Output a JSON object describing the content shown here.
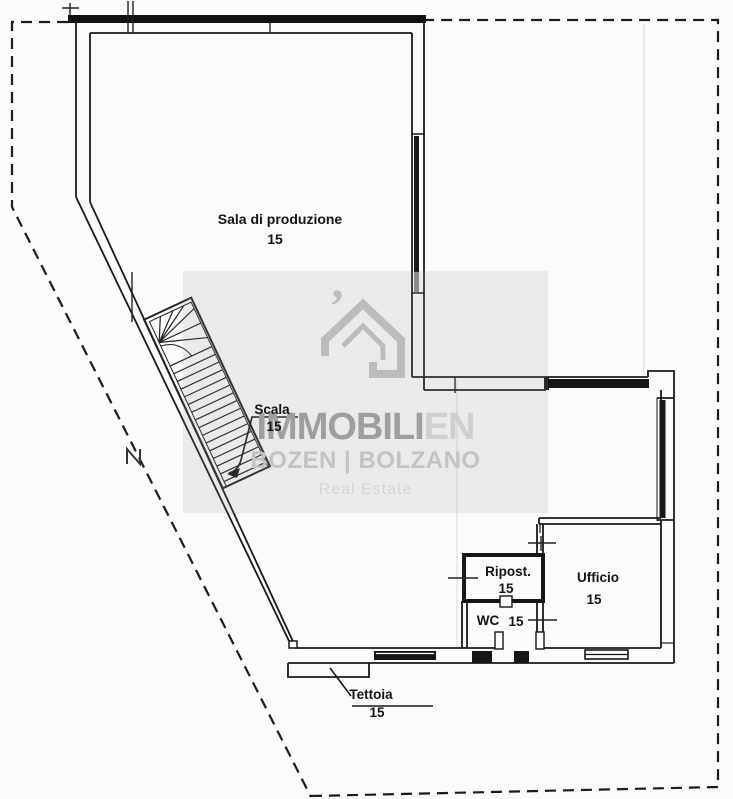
{
  "rooms": {
    "sala": {
      "label": "Sala di produzione",
      "area": "15"
    },
    "scala": {
      "label": "Scala",
      "area": "15"
    },
    "ripost": {
      "label": "Ripost.",
      "area": "15"
    },
    "wc": {
      "label": "WC",
      "area": "15"
    },
    "ufficio": {
      "label": "Ufficio",
      "area": "15"
    },
    "tettoia": {
      "label": "Tettoia",
      "area": "15"
    }
  },
  "watermark": {
    "brand_bold": "IMMOBILI",
    "brand_light": "EN",
    "location": "BOZEN | BOLZANO",
    "tagline": "Real Estate"
  },
  "colors": {
    "ink": "#1a1a1a",
    "paper": "#fbfbfb",
    "watermark_gray": "#b5b5b5",
    "watermark_box": "rgba(150,150,150,0.16)"
  }
}
